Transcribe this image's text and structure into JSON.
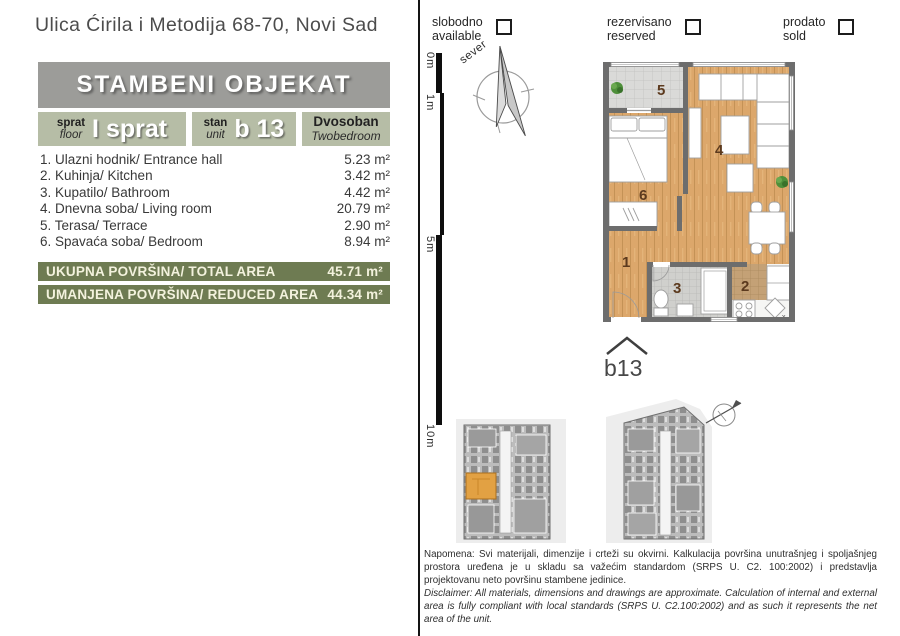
{
  "page": {
    "address": "Ulica Ćirila i Metodija 68-70, Novi Sad"
  },
  "unit_card": {
    "building_title": "STAMBENI OBJEKAT",
    "floor": {
      "label_sr": "sprat",
      "label_en": "floor",
      "value": "I sprat"
    },
    "unit": {
      "label_sr": "stan",
      "label_en": "unit",
      "value": "b 13"
    },
    "type": {
      "value_sr": "Dvosoban",
      "value_en": "Twobedroom"
    }
  },
  "rooms": [
    {
      "name": "1. Ulazni hodnik/ Entrance hall",
      "area": "5.23 m²"
    },
    {
      "name": "2. Kuhinja/ Kitchen",
      "area": "3.42 m²"
    },
    {
      "name": "3. Kupatilo/ Bathroom",
      "area": "4.42 m²"
    },
    {
      "name": "4. Dnevna soba/ Living room",
      "area": "20.79 m²"
    },
    {
      "name": "5. Terasa/ Terrace",
      "area": "2.90 m²"
    },
    {
      "name": "6. Spavaća soba/ Bedroom",
      "area": "8.94 m²"
    }
  ],
  "totals": [
    {
      "label": "UKUPNA POVRŠINA/ TOTAL AREA",
      "value": "45.71 m²"
    },
    {
      "label": "UMANJENA POVRŠINA/ REDUCED AREA",
      "value": "44.34 m²"
    }
  ],
  "status_legend": [
    {
      "sr": "slobodno",
      "en": "available"
    },
    {
      "sr": "rezervisano",
      "en": "reserved"
    },
    {
      "sr": "prodato",
      "en": "sold"
    }
  ],
  "compass": {
    "north_label": "sever"
  },
  "scale_bar": {
    "labels": [
      "0m",
      "1m",
      "5m",
      "10m"
    ]
  },
  "floor_plan": {
    "unit_label": "b13",
    "room_numbers": {
      "hall": "1",
      "kitchen": "2",
      "bathroom": "3",
      "living": "4",
      "terrace": "5",
      "bedroom": "6"
    },
    "sink_mark": "x"
  },
  "notes": {
    "sr": "Napomena: Svi materijali, dimenzije i crteži su okvirni. Kalkulacija površina unutrašnjeg i spoljašnjeg prostora uređena je u skladu sa važećim standardom (SRPS U. C2. 100:2002) i predstavlja projektovanu neto površinu stambene jedinice.",
    "en": "Disclaimer: All materials, dimensions and drawings are approximate. Calculation of internal and external area is fully compliant with local standards (SRPS U. C2.100:2002) and as such it represents the net area of the unit."
  },
  "colors": {
    "sage": "#b6bda6",
    "olive": "#6e7b52",
    "header_gray": "#9c9c99",
    "wall": "#6d6d6d",
    "wood": "#dca76b",
    "highlight_orange": "#e2a143",
    "number_brown": "#5c3a1e"
  }
}
